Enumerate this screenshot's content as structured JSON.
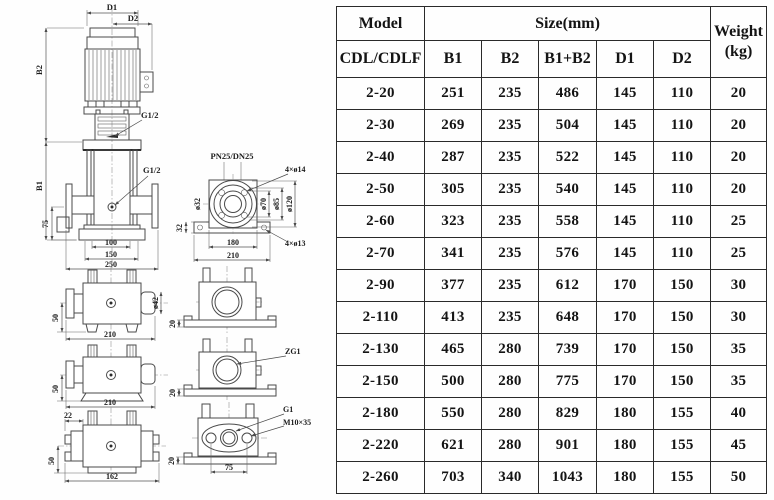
{
  "table": {
    "columns": {
      "model_header": "Model",
      "model_subheader": "CDL/CDLF",
      "size_header": "Size(mm)",
      "size_sub_b1": "B1",
      "size_sub_b2": "B2",
      "size_sub_b1b2": "B1+B2",
      "size_sub_d1": "D1",
      "size_sub_d2": "D2",
      "weight_header_line1": "Weight",
      "weight_header_line2": "(kg)"
    },
    "rows": [
      {
        "model": "2-20",
        "b1": "251",
        "b2": "235",
        "b1_b2": "486",
        "d1": "145",
        "d2": "110",
        "weight": "20"
      },
      {
        "model": "2-30",
        "b1": "269",
        "b2": "235",
        "b1_b2": "504",
        "d1": "145",
        "d2": "110",
        "weight": "20"
      },
      {
        "model": "2-40",
        "b1": "287",
        "b2": "235",
        "b1_b2": "522",
        "d1": "145",
        "d2": "110",
        "weight": "20"
      },
      {
        "model": "2-50",
        "b1": "305",
        "b2": "235",
        "b1_b2": "540",
        "d1": "145",
        "d2": "110",
        "weight": "20"
      },
      {
        "model": "2-60",
        "b1": "323",
        "b2": "235",
        "b1_b2": "558",
        "d1": "145",
        "d2": "110",
        "weight": "25"
      },
      {
        "model": "2-70",
        "b1": "341",
        "b2": "235",
        "b1_b2": "576",
        "d1": "145",
        "d2": "110",
        "weight": "25"
      },
      {
        "model": "2-90",
        "b1": "377",
        "b2": "235",
        "b1_b2": "612",
        "d1": "170",
        "d2": "150",
        "weight": "30"
      },
      {
        "model": "2-110",
        "b1": "413",
        "b2": "235",
        "b1_b2": "648",
        "d1": "170",
        "d2": "150",
        "weight": "30"
      },
      {
        "model": "2-130",
        "b1": "465",
        "b2": "280",
        "b1_b2": "739",
        "d1": "170",
        "d2": "150",
        "weight": "35"
      },
      {
        "model": "2-150",
        "b1": "500",
        "b2": "280",
        "b1_b2": "775",
        "d1": "170",
        "d2": "150",
        "weight": "35"
      },
      {
        "model": "2-180",
        "b1": "550",
        "b2": "280",
        "b1_b2": "829",
        "d1": "180",
        "d2": "155",
        "weight": "40"
      },
      {
        "model": "2-220",
        "b1": "621",
        "b2": "280",
        "b1_b2": "901",
        "d1": "180",
        "d2": "155",
        "weight": "45"
      },
      {
        "model": "2-260",
        "b1": "703",
        "b2": "340",
        "b1_b2": "1043",
        "d1": "180",
        "d2": "155",
        "weight": "50"
      }
    ]
  },
  "drawings": {
    "main": {
      "d1": "D1",
      "d2": "D2",
      "b2": "B2",
      "b1": "B1",
      "vent_thread": "G1/2",
      "drain_thread": "G1/2",
      "h75": "75",
      "w100": "100",
      "w150": "150",
      "w250": "250"
    },
    "flange": {
      "title": "PN25/DN25",
      "holes_top": "4×ø14",
      "holes_bottom": "4×ø13",
      "dia_pipe": "ø32",
      "dia70": "ø70",
      "dia85": "ø85",
      "dia120": "ø120",
      "h32": "32",
      "w180": "180",
      "w210": "210"
    },
    "side1": {
      "h50": "50",
      "w210": "210",
      "dia42": "ø42"
    },
    "end1": {
      "h20": "20"
    },
    "side2": {
      "h50": "50",
      "w210": "210"
    },
    "end2": {
      "h20": "20",
      "thread": "ZG1"
    },
    "side3": {
      "off22": "22",
      "h50": "50",
      "w162": "162"
    },
    "end3": {
      "h20": "20",
      "thread": "G1",
      "bolt": "M10×35",
      "w75": "75"
    }
  }
}
